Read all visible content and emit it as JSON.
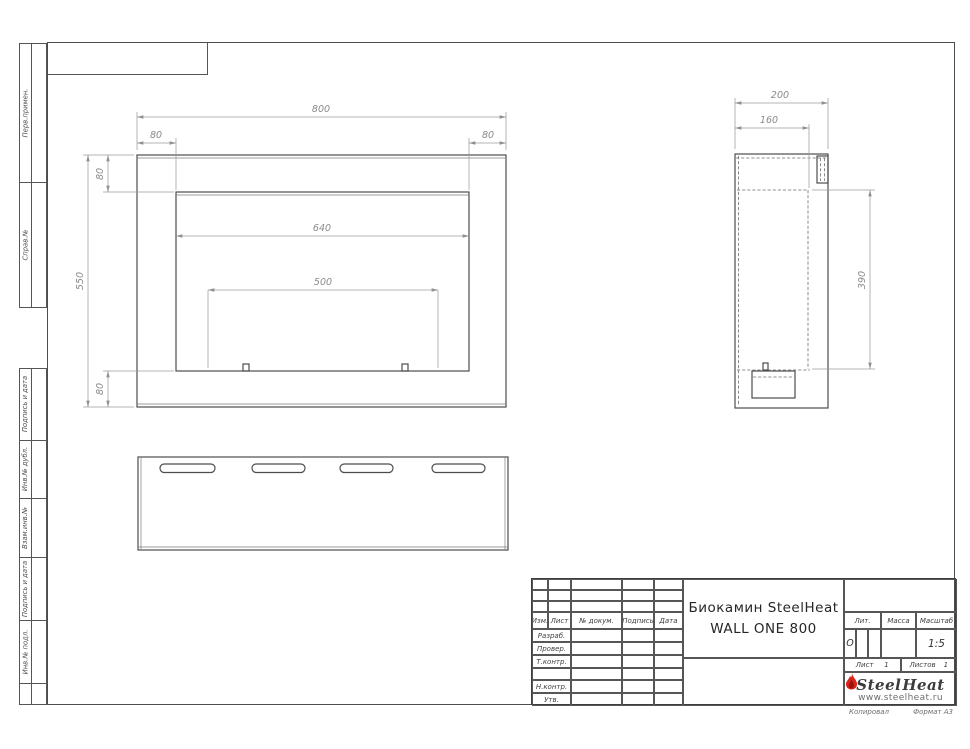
{
  "page": {
    "background": "#ffffff",
    "object_line_color": "#4d4d4d",
    "dimension_color": "#8a8a8a",
    "hidden_line_color": "#6f6f6f",
    "accent_red": "#d6251d"
  },
  "side_strip": {
    "labels": [
      "Перв.примен.",
      "Справ.№",
      "Подпись и дата",
      "Инв.№ дубл.",
      "Взам.инв.№",
      "Подпись и дата",
      "Инв.№ подл."
    ]
  },
  "dims": {
    "front": {
      "width": "800",
      "margin_left": "80",
      "margin_right": "80",
      "top_offset": "80",
      "opening_width": "640",
      "burner_width": "500",
      "height": "550",
      "bottom_offset": "80"
    },
    "side": {
      "depth": "200",
      "inner_depth": "160",
      "opening_height": "390"
    }
  },
  "title_block": {
    "rev_header": [
      "Изм.",
      "Лист",
      "№ докум.",
      "Подпись",
      "Дата"
    ],
    "role_rows": [
      "Разраб.",
      "Провер.",
      "Т.контр.",
      "",
      "Н.контр.",
      "Утв."
    ],
    "doc_title_line1": "Биокамин SteelHeat",
    "doc_title_line2": "WALL ONE 800",
    "lit_label": "Лит.",
    "lit_value": "О",
    "mass_label": "Масса",
    "scale_label": "Масштаб",
    "scale_value": "1:5",
    "sheet_label": "Лист",
    "sheet_number": "1",
    "sheets_label": "Листов",
    "sheets_total": "1",
    "logo_steel": "Steel",
    "logo_heat": "Heat",
    "logo_url": "www.steelheat.ru"
  },
  "footer": {
    "copied_by": "Копировал",
    "format": "Формат А3"
  }
}
